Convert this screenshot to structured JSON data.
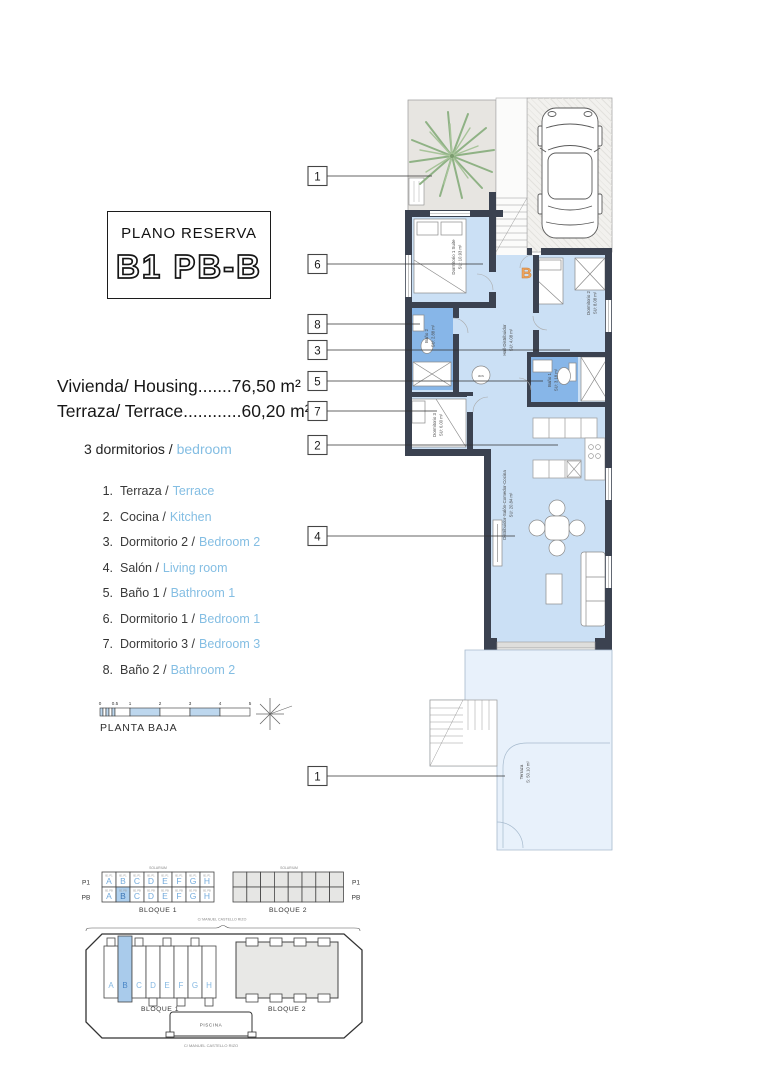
{
  "title_box": {
    "label": "PLANO RESERVA",
    "code": "B1 PB-B"
  },
  "areas": {
    "line1": "Vivienda/ Housing.......76,50 m²",
    "line2": "Terraza/ Terrace............60,20 m²"
  },
  "bedrooms": {
    "es": "3 dormitorios /",
    "en": "bedroom"
  },
  "legend": [
    {
      "num": "1.",
      "es": "Terraza /",
      "en": "Terrace"
    },
    {
      "num": "2.",
      "es": "Cocina /",
      "en": "Kitchen"
    },
    {
      "num": "3.",
      "es": "Dormitorio 2 /",
      "en": "Bedroom 2"
    },
    {
      "num": "4.",
      "es": "Salón /",
      "en": "Living room"
    },
    {
      "num": "5.",
      "es": "Baño 1 /",
      "en": "Bathroom 1"
    },
    {
      "num": "6.",
      "es": "Dormitorio 1 /",
      "en": "Bedroom 1"
    },
    {
      "num": "7.",
      "es": "Dormitorio 3 /",
      "en": "Bedroom 3"
    },
    {
      "num": "8.",
      "es": "Baño 2 /",
      "en": "Bathroom 2"
    }
  ],
  "scale_bar": {
    "ticks": [
      "0",
      "0.5",
      "1",
      "2",
      "3",
      "4",
      "5"
    ],
    "caption": "PLANTA BAJA"
  },
  "plan": {
    "callouts": [
      "1",
      "6",
      "8",
      "3",
      "5",
      "7",
      "2",
      "4",
      "1"
    ],
    "entrance_letter": "B",
    "acs_label": "acs",
    "rooms": {
      "bedroom1": {
        "name": "Dormitorio 1 Suite",
        "area": "SU: 10.93 m²"
      },
      "bedroom2": {
        "name": "Dormitorio 2",
        "area": "SU: 8.08 m²"
      },
      "hall": {
        "name": "Hall-Distribuidor",
        "area": "SU: 4.08 m²"
      },
      "bath2": {
        "name": "Baño 2",
        "area": "SU: 2.88 m²"
      },
      "bath1": {
        "name": "Baño 1",
        "area": "SU: 3.18 m²"
      },
      "bedroom3": {
        "name": "Dormitorio 3",
        "area": "SU: 6.00 m²"
      },
      "living": {
        "name": "Distribuidor-Salón-Comedor-Cocina",
        "area": "SU: 20.84 m²"
      },
      "terrace": {
        "name": "Terraza",
        "area": "S: 50.10 m²"
      }
    }
  },
  "blocks_table": {
    "left_rows": [
      "P1",
      "PB"
    ],
    "right_rows": [
      "P1",
      "PB"
    ],
    "letters": [
      "A",
      "B",
      "C",
      "D",
      "E",
      "F",
      "G",
      "H"
    ],
    "solarium": "SOLARIUM",
    "bloque1": "BLOQUE 1",
    "bloque2": "BLOQUE 2",
    "street": "C/ MANUEL CASTELLO RIZO",
    "unit_code_p1": "B1 P1",
    "unit_code_pb": "B1 PB"
  },
  "site_plan": {
    "letters": [
      "A",
      "B",
      "C",
      "D",
      "E",
      "F",
      "G",
      "H"
    ],
    "bloque1": "BLOQUE 1",
    "bloque2": "BLOQUE 2",
    "piscina": "PISCINA",
    "street": "C/ MANUEL CASTELLO RIZO"
  },
  "colors": {
    "accent_text": "#84BEE3",
    "floor": "#CBE0F5",
    "bath": "#87B6E8",
    "wall": "#3B4250",
    "terrace_bottom": "#E8F1FB",
    "patio_gray": "#E7E5E1",
    "driveway": "#F2F1EE",
    "highlight_cell": "#AFD0EE",
    "entrance_orange": "#E8964F"
  }
}
